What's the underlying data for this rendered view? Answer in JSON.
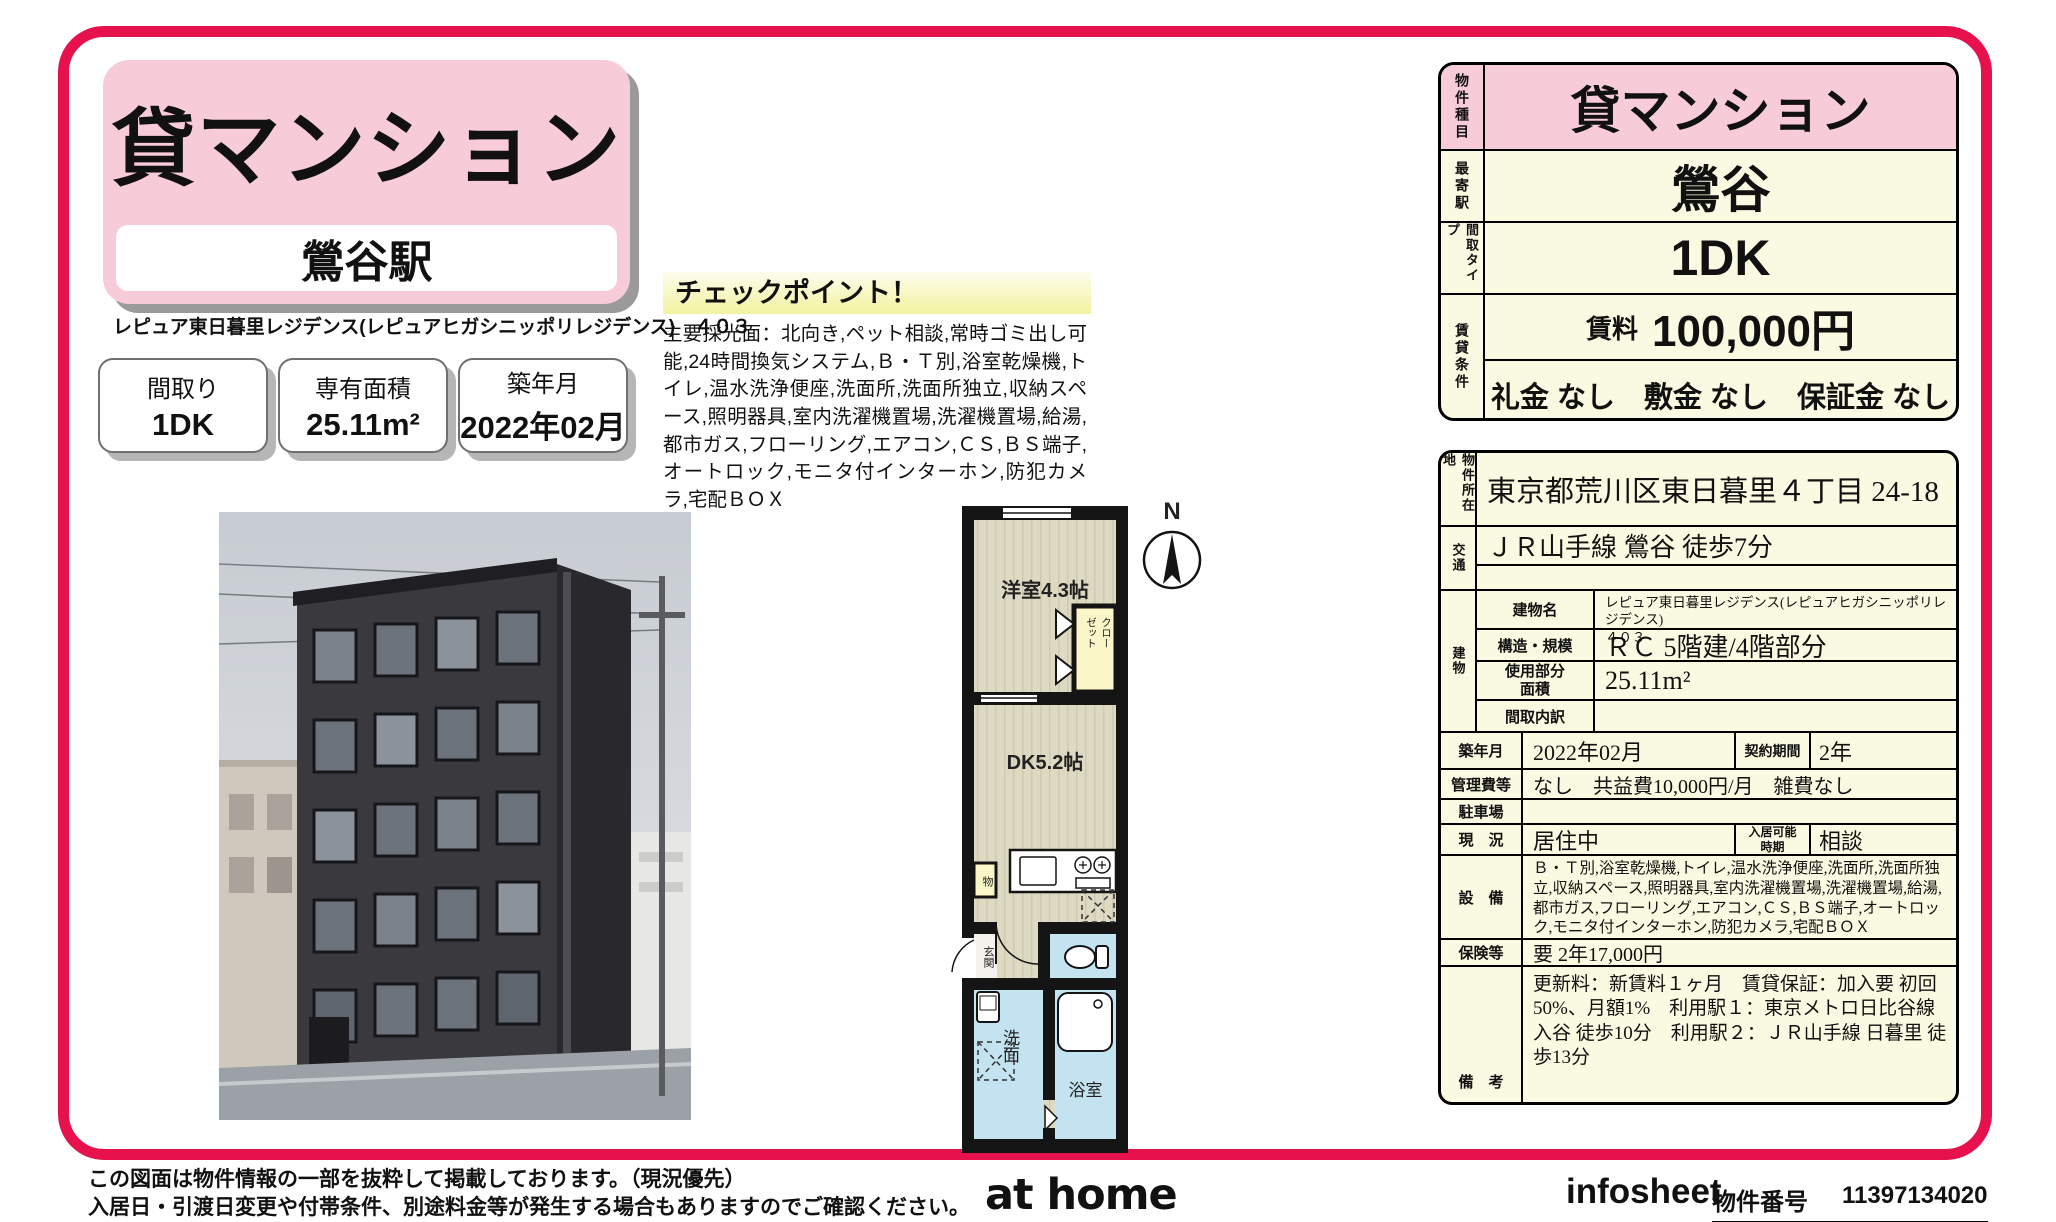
{
  "header": {
    "property_type": "貸マンション",
    "station": "鶯谷駅",
    "property_name": "レピュア東日暮里レジデンス(レピュアヒガシニッポリレジデンス)　４０３",
    "spec_boxes": [
      {
        "label": "間取り",
        "value": "1DK"
      },
      {
        "label": "専有面積",
        "value": "25.11m²"
      },
      {
        "label": "築年月",
        "value": "2022年02月"
      }
    ]
  },
  "checkpoint": {
    "title": "チェックポイント！",
    "body": "主要採光面：北向き,ペット相談,常時ゴミ出し可能,24時間換気システム,Ｂ・Ｔ別,浴室乾燥機,トイレ,温水洗浄便座,洗面所,洗面所独立,収納スペース,照明器具,室内洗濯機置場,洗濯機置場,給湯,都市ガス,フローリング,エアコン,ＣＳ,ＢＳ端子,オートロック,モニタ付インターホン,防犯カメラ,宅配ＢＯＸ"
  },
  "floorplan": {
    "compass": "N",
    "western_room": "洋室4.3帖",
    "dk": "DK5.2帖",
    "closet": "クローゼット",
    "storage": "物",
    "entrance": "玄関",
    "washroom": "洗面",
    "bathroom": "浴室"
  },
  "summary": {
    "type_label": "物件種目",
    "type_value": "貸マンション",
    "station_label": "最寄駅",
    "station_value": "鶯谷",
    "layout_label": "間取タイプ",
    "layout_value": "1DK",
    "terms_label": "賃貸条件",
    "rent_label": "賃料",
    "rent_value": "100,000円",
    "fees": "礼金 なし　敷金 なし　保証金 なし"
  },
  "details": {
    "location_label": "物件所在地",
    "location": "東京都荒川区東日暮里４丁目 24-18",
    "access_label": "交通",
    "access": "ＪＲ山手線 鶯谷 徒歩7分",
    "building_label": "建物",
    "building_name_label": "建物名",
    "building_name": "レピュア東日暮里レジデンス(レピュアヒガシニッポリレジデンス)\n４０３",
    "structure_label": "構造・規模",
    "structure": "ＲＣ 5階建/4階部分",
    "area_label": "使用部分面積",
    "area": "25.11m²",
    "layout_detail_label": "間取内訳",
    "layout_detail": "",
    "built_label": "築年月",
    "built": "2022年02月",
    "contract_label": "契約期間",
    "contract": "2年",
    "mgmt_label": "管理費等",
    "mgmt": "なし　共益費10,000円/月　雑費なし",
    "parking_label": "駐車場",
    "parking": "",
    "status_label": "現　況",
    "status": "居住中",
    "movein_label": "入居可能時期",
    "movein": "相談",
    "equipment_label": "設　備",
    "equipment": "Ｂ・Ｔ別,浴室乾燥機,トイレ,温水洗浄便座,洗面所,洗面所独立,収納スペース,照明器具,室内洗濯機置場,洗濯機置場,給湯,都市ガス,フローリング,エアコン,ＣＳ,ＢＳ端子,オートロック,モニタ付インターホン,防犯カメラ,宅配ＢＯＸ",
    "insurance_label": "保険等",
    "insurance": "要 2年17,000円",
    "notes_label": "備　考",
    "notes": "更新料：新賃料１ヶ月　賃貸保証：加入要 初回50%、月額1%　利用駅１：東京メトロ日比谷線 入谷 徒歩10分　利用駅２：ＪＲ山手線 日暮里 徒歩13分"
  },
  "footer": {
    "disclaimer1": "この図面は物件情報の一部を抜粋して掲載しております。（現況優先）",
    "disclaimer2": "入居日・引渡日変更や付帯条件、別途料金等が発生する場合もありますのでご確認ください。",
    "logo": "at home",
    "infosheet": "infosheet",
    "property_no_label": "物件番号",
    "property_no": "11397134020"
  },
  "colors": {
    "accent_red": "#e6114d",
    "pink": "#f8cbd9",
    "cream": "#fafae2",
    "highlight_yellow": "#f3f3a6",
    "plan_blue": "#c3e3f0",
    "plan_beige": "#ded9c3"
  }
}
